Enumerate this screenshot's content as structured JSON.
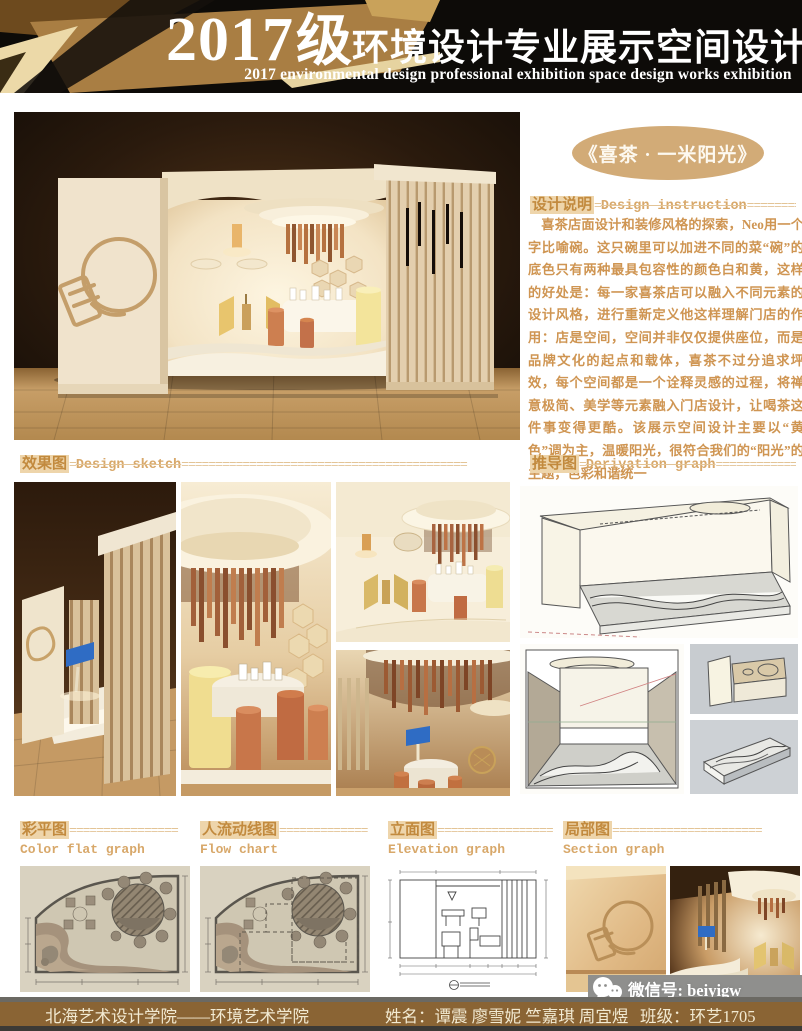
{
  "header": {
    "year": "2017",
    "grade": "级",
    "title_cn": "环境设计专业展示空间设计作品展",
    "title_en": "2017 environmental design professional exhibition space design works exhibition"
  },
  "project": {
    "title": "《喜茶 · 一米阳光》"
  },
  "design_note": {
    "label_cn": "设计说明",
    "eq": "=",
    "label_en": "Design instruction",
    "fill": "=============",
    "body": "喜茶店面设计和装修风格的探索，Neo用一个字比喻碗。这只碗里可以加进不同的菜“碗”的底色只有两种最具包容性的颜色白和黄，这样的好处是：每一家喜茶店可以融入不同元素的设计风格，进行重新定义他这样理解门店的作用：店是空间，空间并非仅仅提供座位，而是品牌文化的起点和载体，喜茶不过分追求坪效，每个空间都是一个诠释灵感的过程，将禅意极简、美学等元素融入门店设计，让喝茶这件事变得更酷。该展示空间设计主要以“黄色”调为主，温暖阳光，很符合我们的“阳光”的主题，色彩和谐统一"
  },
  "sections": {
    "sketch": {
      "label_cn": "效果图",
      "eq": "=",
      "label_en": "Design sketch",
      "fill": "=========================================="
    },
    "derivation": {
      "label_cn": "推导图",
      "eq": "=",
      "label_en": "Derivation graph",
      "fill": "================"
    },
    "color_flat": {
      "label_cn": "彩平图",
      "fill": "================",
      "label_en": "Color flat graph"
    },
    "flow": {
      "label_cn": "人流动线图",
      "fill": "=============",
      "label_en": "Flow chart"
    },
    "elevation": {
      "label_cn": "立面图",
      "fill": "=================",
      "label_en": "Elevation graph"
    },
    "section": {
      "label_cn": "局部图",
      "fill": "======================",
      "label_en": "Section graph"
    }
  },
  "footer": {
    "school": "北海艺术设计学院——环境艺术学院",
    "names": "姓名：谭震 廖雪妮 竺嘉琪 周宜煜",
    "class": "班级：环艺1705",
    "wechat": "微信号: beiyigw"
  },
  "colors": {
    "accent_tan": "#d2ab77",
    "label_gold": "#c28a3e",
    "highlight": "#eed5ab",
    "body_text": "#cf9552",
    "footer_brown": "#8a6434",
    "header_black": "#0d0b08"
  }
}
